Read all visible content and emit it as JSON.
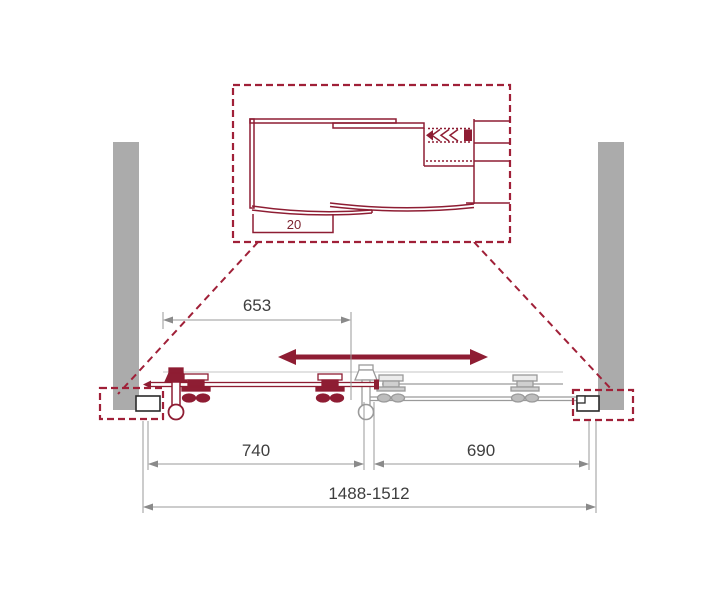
{
  "diagram": {
    "detail": {
      "offset_label": "20"
    },
    "dimensions": {
      "stroke": "653",
      "sliding_panel": "740",
      "fixed_panel": "690",
      "overall": "1488-1512"
    },
    "colors": {
      "accent": "#8E1D33",
      "wall": "#ABABAB"
    }
  }
}
